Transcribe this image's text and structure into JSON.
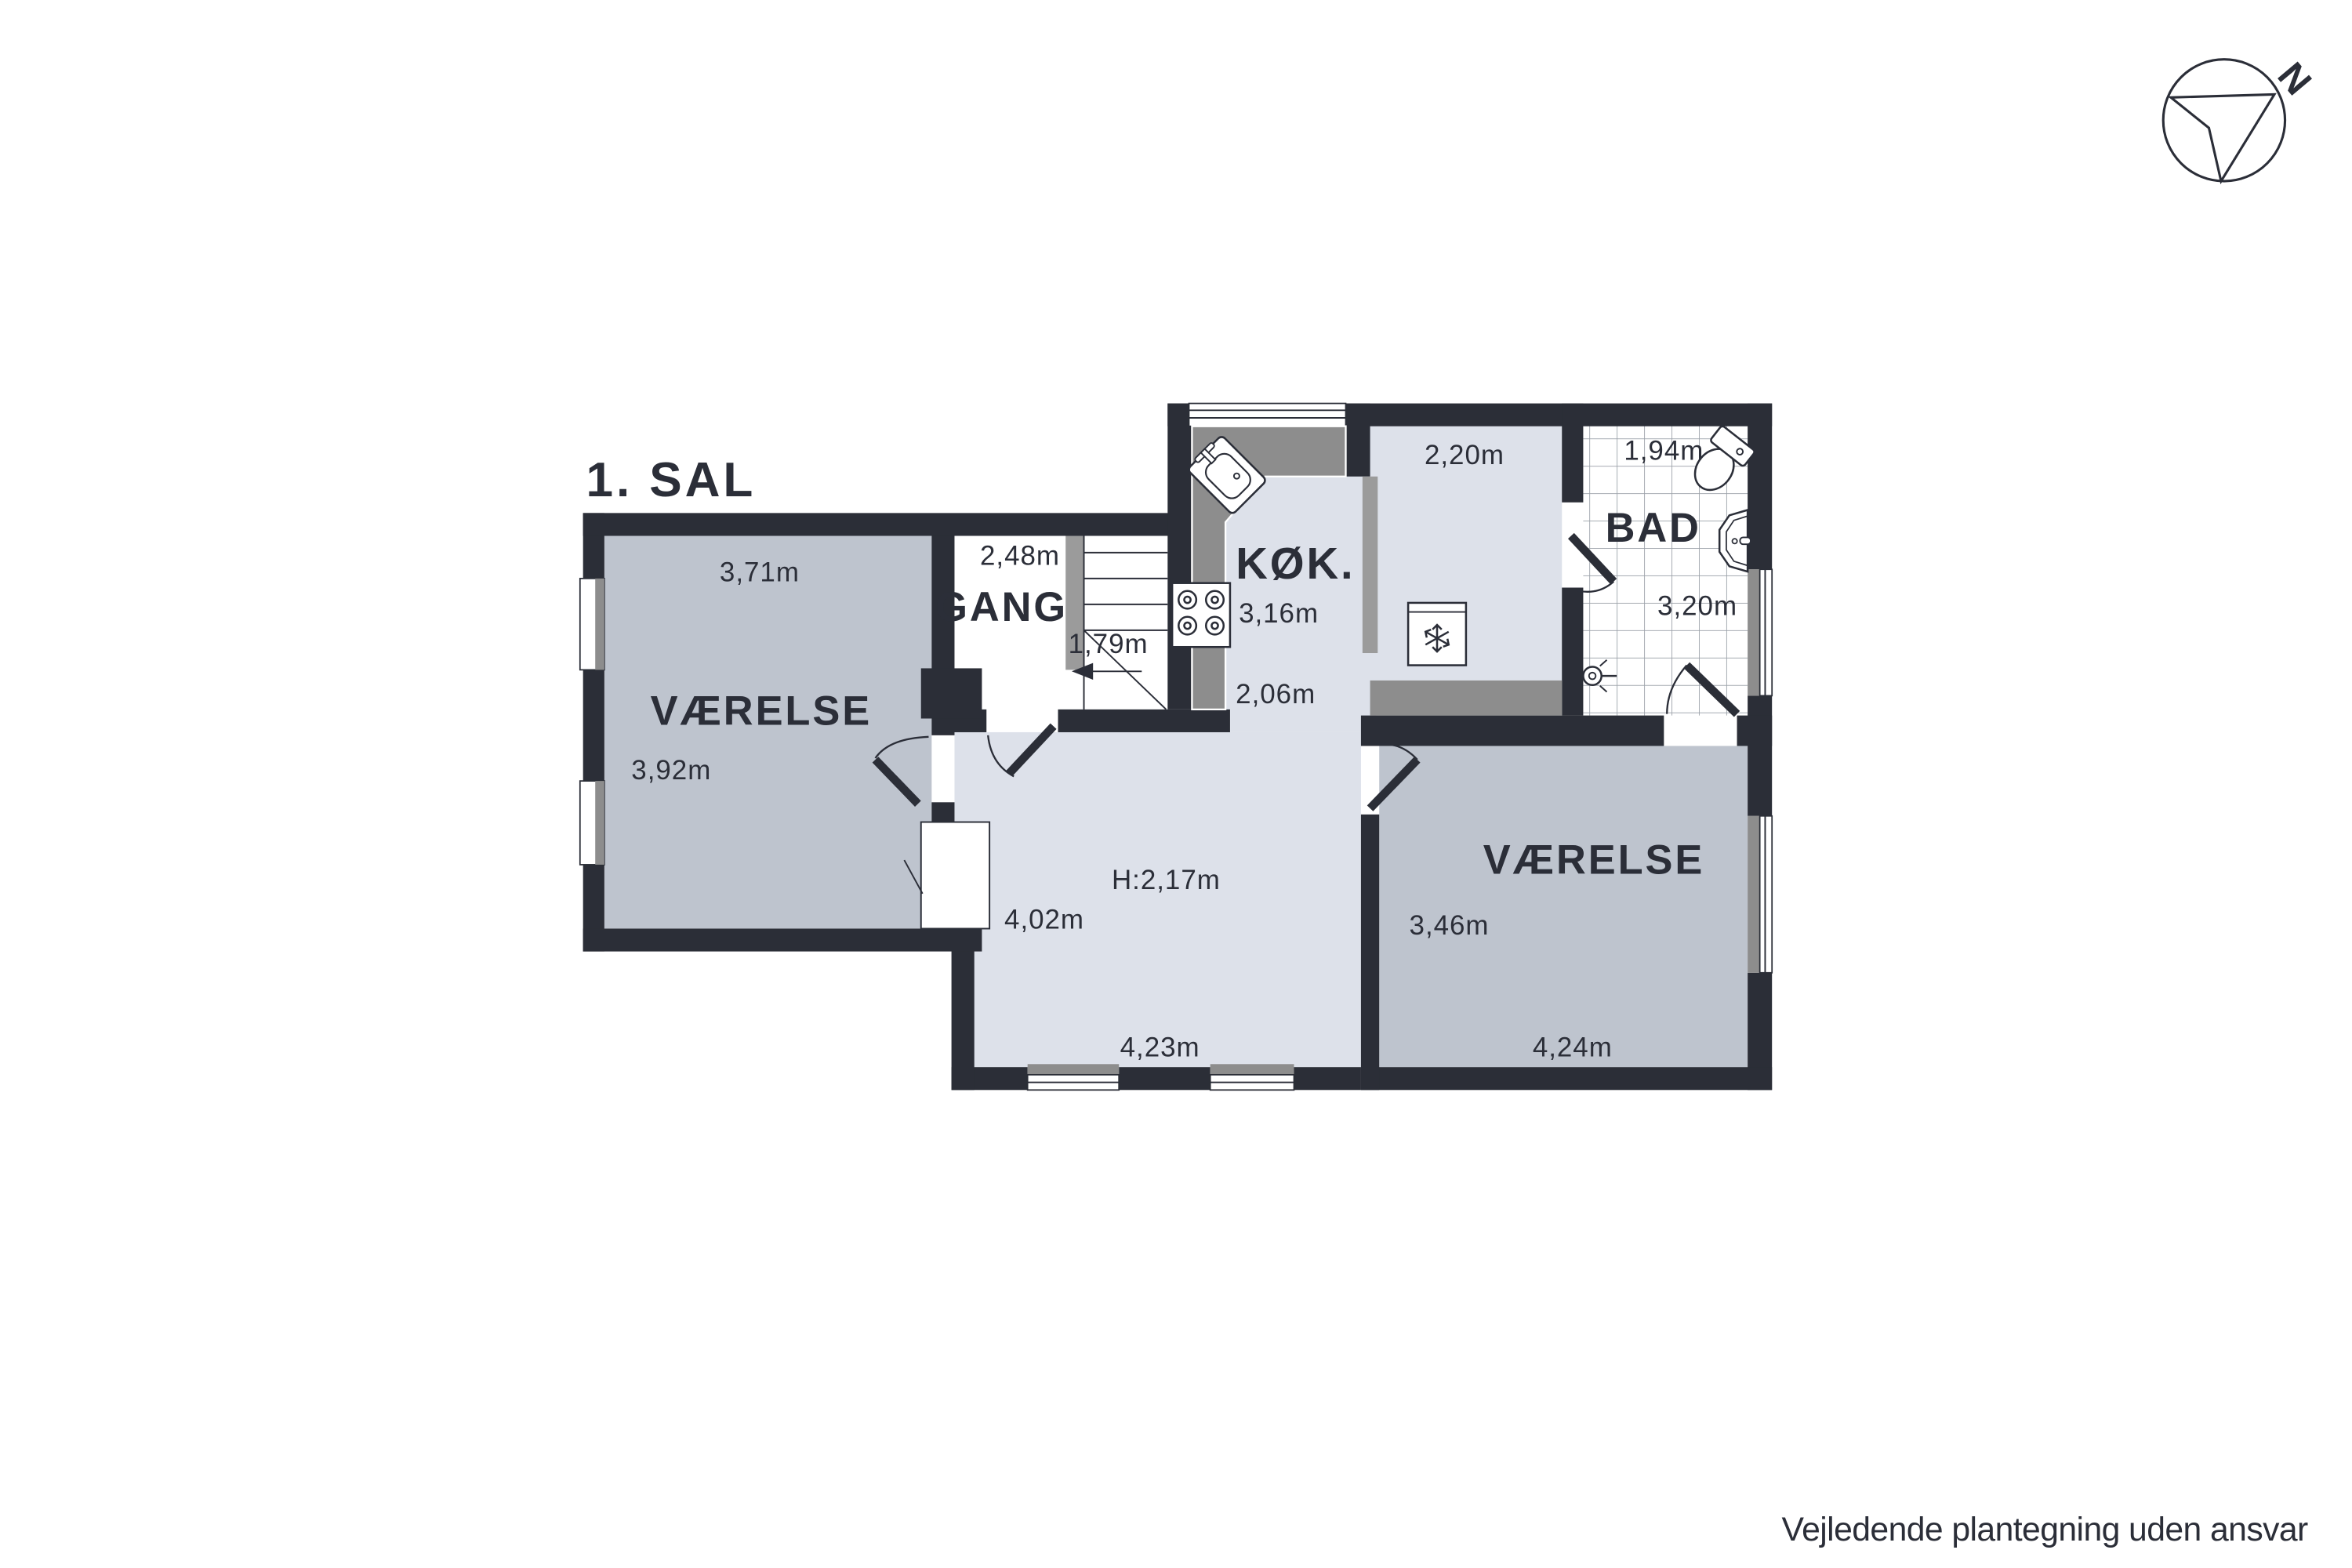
{
  "title": "1. SAL",
  "disclaimer": "Vejledende plantegning uden ansvar",
  "compass": {
    "north_label": "N"
  },
  "colors": {
    "wall": "#2b2e37",
    "room_gray_fill": "#bec4ce",
    "room_light_fill": "#dde1ea",
    "counter_gray": "#8d8d8d",
    "partition_gray": "#9b9b9b",
    "tile_line": "#9aa0a8",
    "text": "#2b2e38",
    "background": "#ffffff"
  },
  "rooms": {
    "vaerelse_left": {
      "name": "VÆRELSE",
      "width_label": "3,71m",
      "depth_label": "3,92m"
    },
    "gang": {
      "name": "GANG",
      "width_label": "2,48m",
      "stairs_width_label": "1,79m"
    },
    "koekken": {
      "name": "KØK.",
      "width_label": "3,16m",
      "lower_width_label": "2,06m"
    },
    "room_2_20": {
      "width_label": "2,20m"
    },
    "bad": {
      "name": "BAD",
      "width_label": "1,94m",
      "depth_label": "3,20m"
    },
    "center_room": {
      "ceiling_height_label": "H:2,17m",
      "depth_label": "4,02m",
      "width_label": "4,23m"
    },
    "vaerelse_right": {
      "name": "VÆRELSE",
      "depth_label": "3,46m",
      "width_label": "4,24m"
    }
  }
}
